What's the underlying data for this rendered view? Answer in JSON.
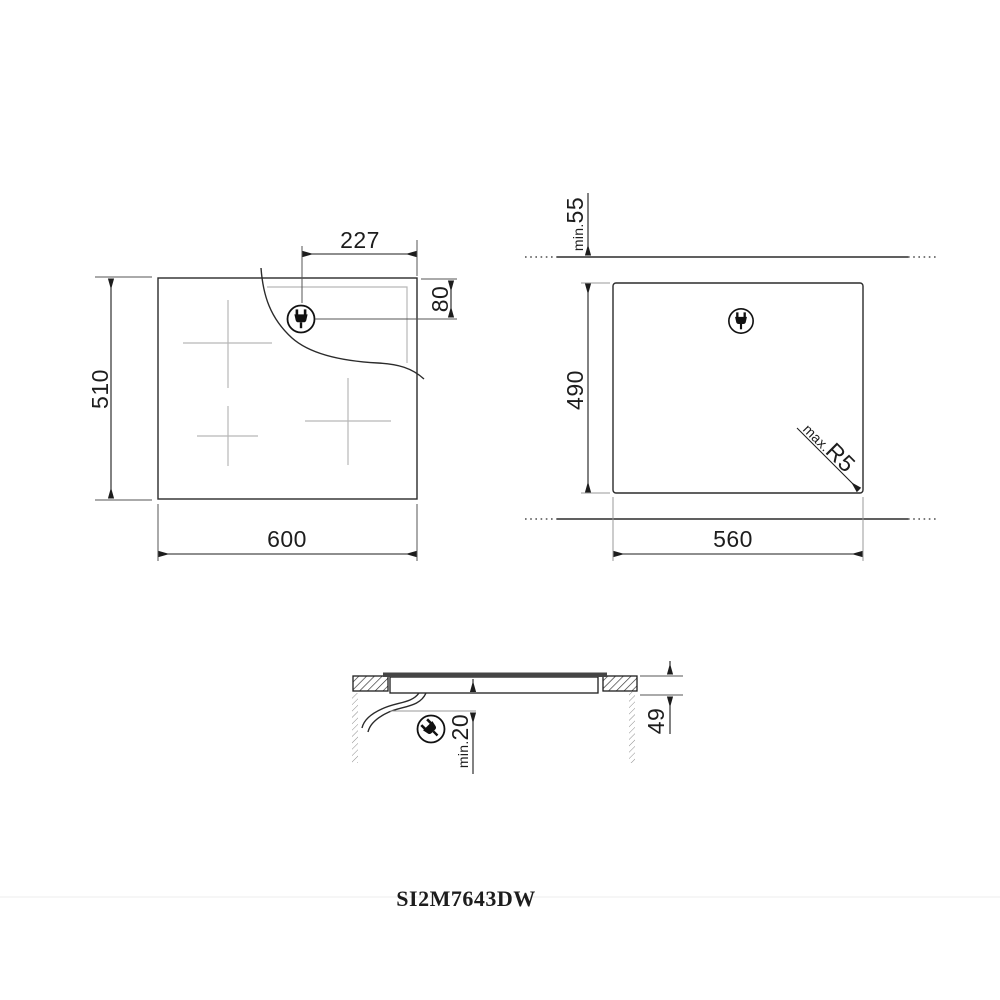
{
  "drawing": {
    "model": "SI2M7643DW",
    "top_view": {
      "width": "600",
      "height": "510",
      "plug_offset_x": "227",
      "plug_offset_y": "80"
    },
    "cutout_view": {
      "width": "560",
      "height": "490",
      "rear_clearance": {
        "prefix": "min.",
        "value": "55"
      },
      "corner_radius": {
        "prefix": "max.",
        "value": "R5"
      }
    },
    "section_view": {
      "recess_depth": "49",
      "bottom_clearance": {
        "prefix": "min.",
        "value": "20"
      }
    }
  },
  "icons": {
    "power_plug": "plug-in-circle"
  },
  "colors": {
    "background": "#ffffff",
    "line": "#2b2b2b",
    "light_gray": "#b7b7b7",
    "divider": "#ececec"
  }
}
